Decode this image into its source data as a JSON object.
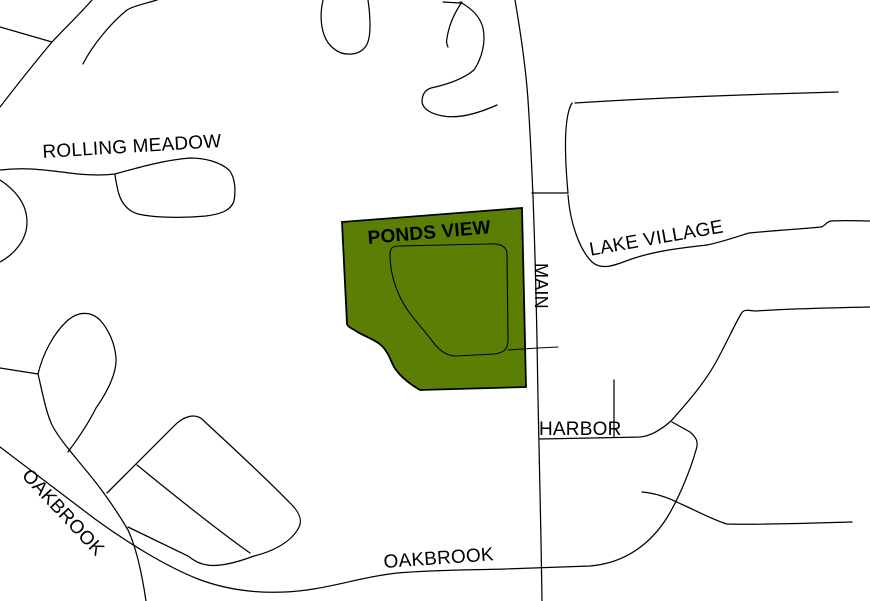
{
  "map": {
    "background": "#ffffff",
    "road_color": "#000000",
    "road_width": 1.25,
    "street_names": [
      "ROLLING MEADOW",
      "PONDS VIEW",
      "LAKE VILLAGE",
      "MAIN",
      "HARBOR",
      "OAKBROOK"
    ],
    "parcel": {
      "name": "PONDS VIEW",
      "fill": "#5b7f05",
      "outline": "#000000",
      "outline_width": 1.8,
      "path": "M342,222 L522,208 L526,387 L420,390 C408,383 399,375 394,367 C390,359 388,352 382,346 C375,339 363,336 356,331 C351,328 348,327 347,324 L342,222 Z"
    },
    "roads": [
      {
        "id": "rolling-meadow-west-diagonal",
        "path": "M92,0 C78,16 64,29 52,42 C36,61 17,85 0,107"
      },
      {
        "id": "west-branch",
        "path": "M0,27 L52,42"
      },
      {
        "id": "northwest-spur",
        "path": "M157,0 C144,4 133,6 127,10 C112,22 93,44 83,64"
      },
      {
        "id": "rolling-meadow",
        "path": "M0,170 C25,167 45,170 62,172 C82,175 98,176 115,174 C140,167 165,160 190,158 C205,158 220,162 229,170 C235,177 236,190 234,201 C231,210 222,214 206,216 C185,218 155,218 138,214 C128,211 121,203 118,191 C116,181 115,177 115,174"
      },
      {
        "id": "west-curve",
        "path": "M0,180 C14,189 27,203 27,222 C27,241 13,255 0,262"
      },
      {
        "id": "west-loop",
        "path": "M38,374 C43,353 54,333 67,321 C78,311 91,311 100,320 C109,330 115,344 116,358 C117,372 108,391 96,408 C88,424 77,440 68,452"
      },
      {
        "id": "west-spoke",
        "path": "M0,368 L38,374"
      },
      {
        "id": "southwest-diagonal",
        "path": "M38,374 C43,395 46,412 52,425 C62,444 82,464 100,488 C112,504 121,518 128,530 C136,547 142,574 146,601"
      },
      {
        "id": "oakbrook",
        "path": "M0,447 C30,470 62,494 95,519 C125,541 165,566 198,579 C232,592 270,595 307,590 C342,585 362,577 397,573 C432,570 470,570 505,569 L590,566 C625,563 651,544 668,516 C680,496 691,468 696,450"
      },
      {
        "id": "oakbrook-bend",
        "path": "M696,450 C699,442 696,437 690,432 L672,422"
      },
      {
        "id": "harbor",
        "path": "M540,439 L640,437 C651,436 659,430 665,426 L671,421 C686,404 704,384 716,362 C726,344 735,324 741,314 C744,308 750,311 756,311 C782,309 822,308 870,307"
      },
      {
        "id": "harbor-stub",
        "path": "M614,380 L614,437"
      },
      {
        "id": "southeast-branch",
        "path": "M642,492 C656,493 669,498 681,504 C701,513 716,521 727,524 C762,525 812,523 852,522"
      },
      {
        "id": "main",
        "path": "M515,0 C521,35 526,70 528,100 C531,145 532,175 533,196 C535,250 536,290 537,340 C538,410 540,490 541,540 L542,601"
      },
      {
        "id": "main-connector",
        "path": "M532,193 L568,193"
      },
      {
        "id": "east-parallel",
        "path": "M572,103 C563,118 565,160 568,193"
      },
      {
        "id": "northeast-road",
        "path": "M575,103 C635,99 710,96 770,94 L838,92"
      },
      {
        "id": "lake-village",
        "path": "M568,195 C570,222 579,249 592,262 C601,270 613,266 626,261 C652,251 682,248 707,245 C722,242 736,237 749,233 C780,230 802,229 821,227 C825,226 826,222 831,221 C846,220 858,221 870,221"
      },
      {
        "id": "north-cul-de-sac",
        "path": "M323,0 C319,18 321,38 333,48 C343,57 359,56 366,46 C372,37 370,14 368,0"
      },
      {
        "id": "north-hook",
        "path": "M460,2 C471,8 480,16 483,28 C486,42 482,58 474,70 C462,80 445,85 431,88 C425,90 422,95 422,102 C423,109 431,114 443,116 C459,119 479,113 497,105"
      },
      {
        "id": "north-hook-top",
        "path": "M443,2 L460,3"
      },
      {
        "id": "north-hook-inner",
        "path": "M462,2 C455,12 449,25 447,38 C446,42 447,45 448,47"
      },
      {
        "id": "block-outline",
        "path": "M107,493 C130,470 156,444 173,427 C183,416 196,412 204,421 C233,448 266,478 291,504 C300,513 303,521 298,529 C290,543 271,552 254,556 C238,562 219,567 207,565 C199,564 193,560 188,556 L128,527"
      },
      {
        "id": "block-divider",
        "path": "M137,465 C175,496 220,532 250,553"
      },
      {
        "id": "parcel-loop",
        "path": "M390,254 C390,248 393,246 399,246 L487,244 C500,243 507,246 507,254 L508,340 C508,350 503,353 494,354 L456,356 C446,356 439,350 433,342 C421,326 409,315 401,299 C394,285 390,270 390,254",
        "width": 1.1
      },
      {
        "id": "parcel-connector",
        "path": "M508,350 L538,348 L558,347",
        "width": 1.1
      }
    ],
    "labels": [
      {
        "id": "rolling-meadow",
        "text": "ROLLING MEADOW",
        "x": 42,
        "y": 143,
        "rotation": -3.5,
        "bold": false,
        "size": 19
      },
      {
        "id": "ponds-view",
        "text": "PONDS VIEW",
        "x": 367,
        "y": 229,
        "rotation": -5,
        "bold": true,
        "size": 19
      },
      {
        "id": "lake-village",
        "text": "LAKE VILLAGE",
        "x": 588,
        "y": 241,
        "rotation": -10,
        "bold": false,
        "size": 19
      },
      {
        "id": "main",
        "text": "MAIN",
        "x": 550,
        "y": 263,
        "rotation": 90,
        "bold": false,
        "size": 18
      },
      {
        "id": "harbor",
        "text": "HARBOR",
        "x": 539,
        "y": 420,
        "rotation": 0,
        "bold": false,
        "size": 19
      },
      {
        "id": "oakbrook-sw",
        "text": "OAKBROOK",
        "x": 32,
        "y": 466,
        "rotation": 47,
        "bold": false,
        "size": 19
      },
      {
        "id": "oakbrook-s",
        "text": "OAKBROOK",
        "x": 383,
        "y": 553,
        "rotation": -4,
        "bold": false,
        "size": 19
      }
    ]
  }
}
